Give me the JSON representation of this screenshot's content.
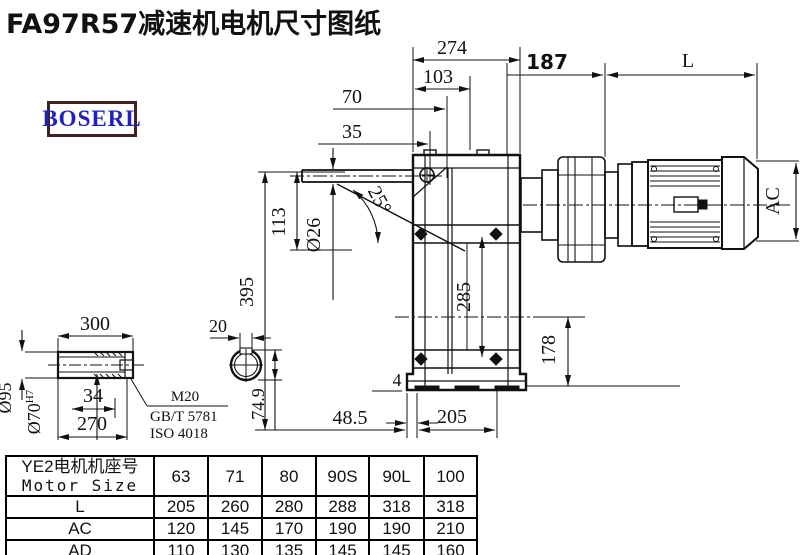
{
  "title": "FA97R57减速机电机尺寸图纸",
  "logo": {
    "text": "BOSERL"
  },
  "colors": {
    "line": "#111111",
    "logo_text": "#2222bb",
    "logo_border": "#3d2323",
    "background": "#ffffff"
  },
  "drawing": {
    "dims": {
      "w274": "274",
      "w103": "103",
      "w70": "70",
      "w35": "35",
      "w187": "187",
      "wL": "L",
      "h395": "395",
      "h113": "113",
      "dia26": "Ø26",
      "ang25": "25°",
      "h285": "285",
      "h178": "178",
      "ac": "AC",
      "b4": "4",
      "b485": "48.5",
      "b205": "205",
      "s300": "300",
      "s34": "34",
      "s270": "270",
      "dia95": "Ø95",
      "dia70": "Ø70",
      "dia70sup": "H7",
      "k20": "20",
      "k749": "74.9",
      "m20": "M20",
      "gb": "GB/T 5781",
      "iso": "ISO 4018"
    }
  },
  "table": {
    "header": {
      "line1": "YE2电机机座号",
      "line2": "Motor Size"
    },
    "sizes": [
      "63",
      "71",
      "80",
      "90S",
      "90L",
      "100"
    ],
    "rows": [
      {
        "label": "L",
        "values": [
          "205",
          "260",
          "280",
          "288",
          "318",
          "318"
        ]
      },
      {
        "label": "AC",
        "values": [
          "120",
          "145",
          "170",
          "190",
          "190",
          "210"
        ]
      },
      {
        "label": "AD",
        "values": [
          "110",
          "130",
          "135",
          "145",
          "145",
          "160"
        ]
      }
    ]
  }
}
